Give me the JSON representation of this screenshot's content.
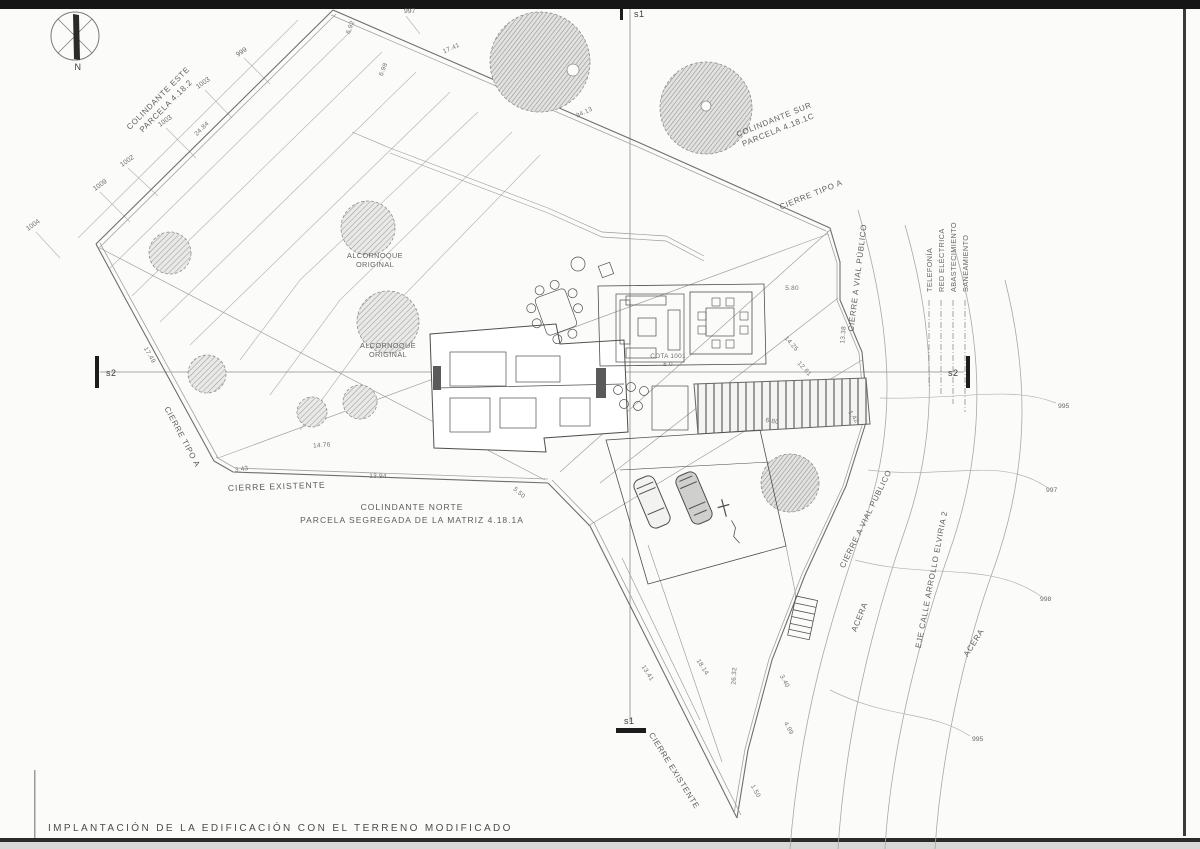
{
  "drawing": {
    "caption": "IMPLANTACIÓN DE LA EDIFICACIÓN CON EL TERRENO MODIFICADO",
    "compass_label": "N"
  },
  "sections": {
    "s1": "s1",
    "s2": "s2"
  },
  "boundaries": {
    "colindante_este_1": "COLINDANTE ESTE",
    "colindante_este_2": "PARCELA 4.18.2",
    "colindante_sur_1": "COLINDANTE SUR",
    "colindante_sur_2": "PARCELA 4.18.1C",
    "colindante_norte_1": "COLINDANTE NORTE",
    "colindante_norte_2": "PARCELA SEGREGADA DE LA MATRIZ 4.18.1A",
    "cierre_tipo_a": "CIERRE TIPO A",
    "cierre_existente": "CIERRE EXISTENTE",
    "cierre_vial": "CIERRE A VIAL PÚBLICO"
  },
  "street": {
    "acera": "ACERA",
    "eje_calle": "EJE CALLE ARROLLO ELVIRIA 2"
  },
  "utilities": {
    "telefonia": "TELEFONÍA",
    "red_electrica": "RED ELÉCTRICA",
    "abastecimiento": "ABASTECIMIENTO",
    "saneamiento": "SANEAMIENTO"
  },
  "trees": {
    "alcornoque_1": "ALCORNOQUE",
    "alcornoque_2": "ORIGINAL"
  },
  "levels": {
    "cota": "COTA 1001",
    "ref": "± 0"
  },
  "contours": [
    "997",
    "999",
    "1003",
    "1003",
    "1002",
    "1009",
    "1004",
    "995",
    "997",
    "998",
    "995"
  ],
  "dimensions": [
    "24.84",
    "6.92",
    "6.98",
    "17.41",
    "34.13",
    "17.49",
    "3.43",
    "13.94",
    "14.76",
    "5.50",
    "5.80",
    "13.38",
    "14.25",
    "12.61",
    "1.42",
    "6.80",
    "13.41",
    "18.14",
    "26.32",
    "3.40",
    "4.99",
    "1.50"
  ],
  "colors": {
    "paper": "#fbfbf9",
    "ink": "#4a4a4a",
    "faint": "#b5b5b5",
    "band": "#161616"
  }
}
